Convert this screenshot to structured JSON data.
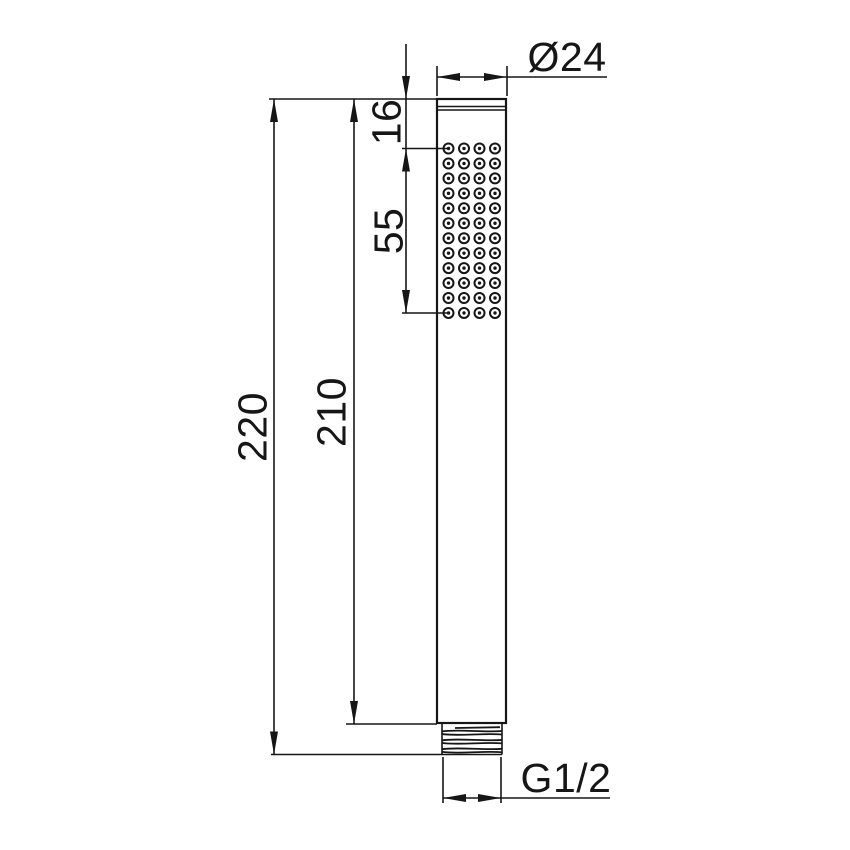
{
  "drawing": {
    "title": "Handshower technical drawing",
    "labels": {
      "diameter_top": "Ø24",
      "head_offset": "16",
      "spray_zone_length": "55",
      "overall_length": "220",
      "body_length": "210",
      "thread_size": "G1/2"
    },
    "nozzle_grid": {
      "columns": 4,
      "rows": 12
    },
    "thread_ridges": 6,
    "line_color": "#161616",
    "background_color": "#ffffff"
  }
}
